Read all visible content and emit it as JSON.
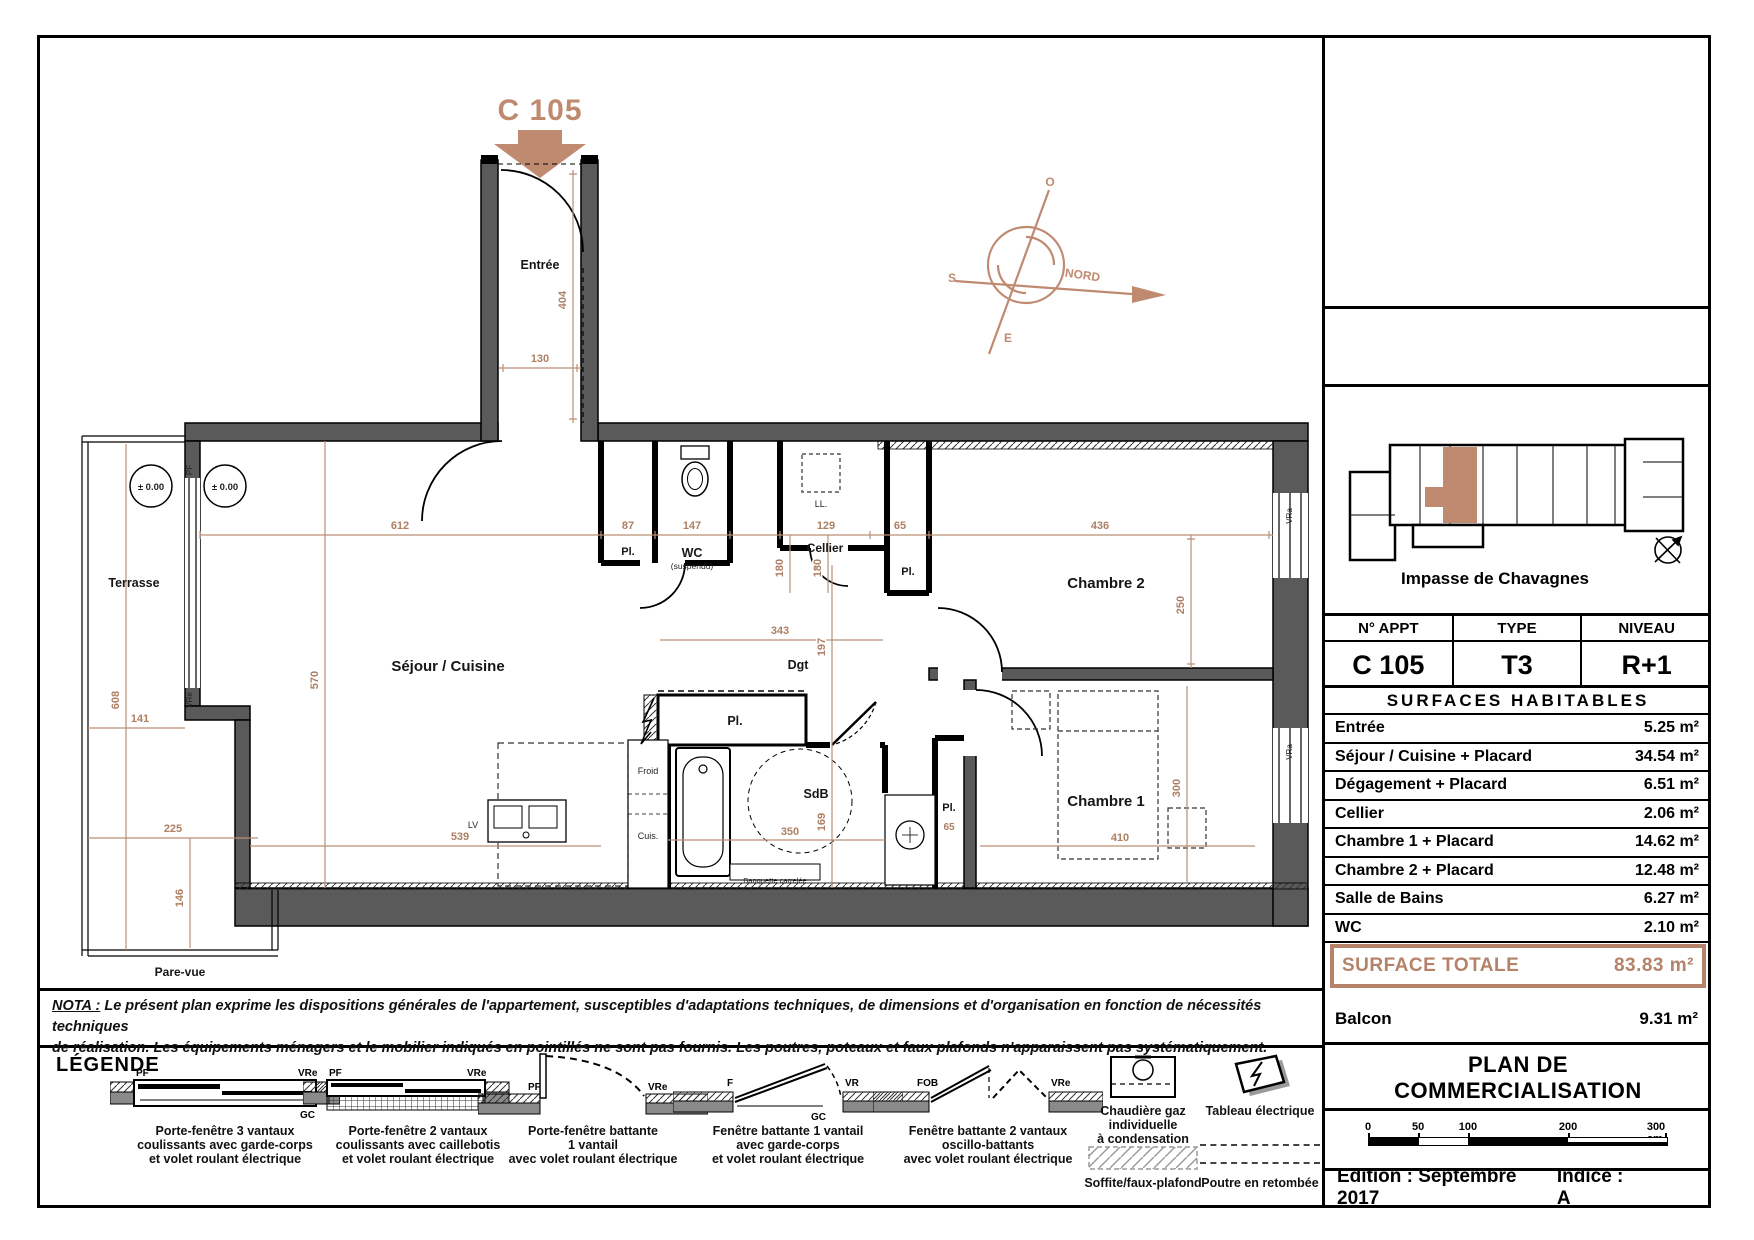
{
  "colors": {
    "accent": "#bf8a70",
    "total": "#b5826a",
    "wall": "#5a5a5a",
    "dim": "#bb8f76"
  },
  "plan": {
    "unit_title": "C 105",
    "labels": {
      "entree": "Entrée",
      "terrasse": "Terrasse",
      "sejour": "Séjour / Cuisine",
      "wc": "WC",
      "wc_sub": "(suspendu)",
      "cellier": "Cellier",
      "ll": "LL.",
      "pl": "Pl.",
      "chambre2": "Chambre 2",
      "chambre1": "Chambre 1",
      "dgt": "Dgt",
      "sdb": "SdB",
      "pare_vue": "Pare-vue",
      "froid": "Froid",
      "cuis": "Cuis.",
      "lv": "LV",
      "banquette": "Banquette carrelée",
      "level": "± 0.00"
    },
    "dims": {
      "d404": "404",
      "d130": "130",
      "d612": "612",
      "d87": "87",
      "d147": "147",
      "d129": "129",
      "d65": "65",
      "d436": "436",
      "d250": "250",
      "d570": "570",
      "d539": "539",
      "d608": "608",
      "d141": "141",
      "d225": "225",
      "d146": "146",
      "d343": "343",
      "d197": "197",
      "d180": "180",
      "d350": "350",
      "d169": "169",
      "d410": "410",
      "d300": "300"
    },
    "win": {
      "pf": "PF",
      "vre": "VRe",
      "vra": "VRa"
    }
  },
  "compass": {
    "o": "O",
    "s": "S",
    "e": "E",
    "nord": "NORD"
  },
  "panel": {
    "street": "Impasse de Chavagnes",
    "table": {
      "h1": "N° APPT",
      "h2": "TYPE",
      "h3": "NIVEAU",
      "v1": "C 105",
      "v2": "T3",
      "v3": "R+1"
    },
    "surfaces_title": "SURFACES HABITABLES",
    "surfaces": [
      {
        "label": "Entrée",
        "value": "5.25 m²"
      },
      {
        "label": "Séjour / Cuisine + Placard",
        "value": "34.54 m²"
      },
      {
        "label": "Dégagement + Placard",
        "value": "6.51 m²"
      },
      {
        "label": "Cellier",
        "value": "2.06 m²"
      },
      {
        "label": "Chambre 1 + Placard",
        "value": "14.62 m²"
      },
      {
        "label": "Chambre 2 + Placard",
        "value": "12.48 m²"
      },
      {
        "label": "Salle de Bains",
        "value": "6.27 m²"
      },
      {
        "label": "WC",
        "value": "2.10 m²"
      }
    ],
    "total": {
      "label": "SURFACE TOTALE",
      "value": "83.83 m²"
    },
    "balcon": {
      "label": "Balcon",
      "value": "9.31 m²"
    },
    "doc_title_1": "PLAN  DE",
    "doc_title_2": "COMMERCIALISATION",
    "scale_ticks": [
      "0",
      "50",
      "100",
      "200",
      "300 cm"
    ],
    "edition": "Edition : Septembre 2017",
    "indice": "Indice : A"
  },
  "nota": {
    "label": "NOTA :",
    "line1": "Le présent plan exprime les dispositions générales de l'appartement, susceptibles d'adaptations techniques, de dimensions et d'organisation en fonction de nécessités techniques",
    "line2": "de réalisation. Les équipements ménagers et le mobilier indiqués en pointillés ne sont pas fournis. Les poutres, poteaux et faux plafonds n'apparaissent pas systématiquement."
  },
  "legend": {
    "title": "LÉGENDE",
    "items": [
      {
        "l1": "Porte-fenêtre 3 vantaux",
        "l2": "coulissants avec garde-corps",
        "l3": "et volet roulant électrique"
      },
      {
        "l1": "Porte-fenêtre 2 vantaux",
        "l2": "coulissants avec caillebotis",
        "l3": "et volet roulant électrique"
      },
      {
        "l1": "Porte-fenêtre battante",
        "l2": "1 vantail",
        "l3": "avec volet roulant électrique"
      },
      {
        "l1": "Fenêtre battante 1 vantail",
        "l2": "avec garde-corps",
        "l3": "et volet roulant électrique"
      },
      {
        "l1": "Fenêtre battante 2 vantaux",
        "l2": "oscillo-battants",
        "l3": "avec volet roulant électrique"
      }
    ],
    "chaudiere": {
      "l1": "Chaudière gaz",
      "l2": "individuelle",
      "l3": "à condensation"
    },
    "tableau": "Tableau électrique",
    "soffite": "Soffite/faux-plafond",
    "poutre": "Poutre en retombée",
    "sym": {
      "pf": "PF",
      "vre": "VRe",
      "gc": "GC",
      "f": "F",
      "vr": "VR",
      "fob": "FOB",
      "vra": "VRa"
    }
  }
}
